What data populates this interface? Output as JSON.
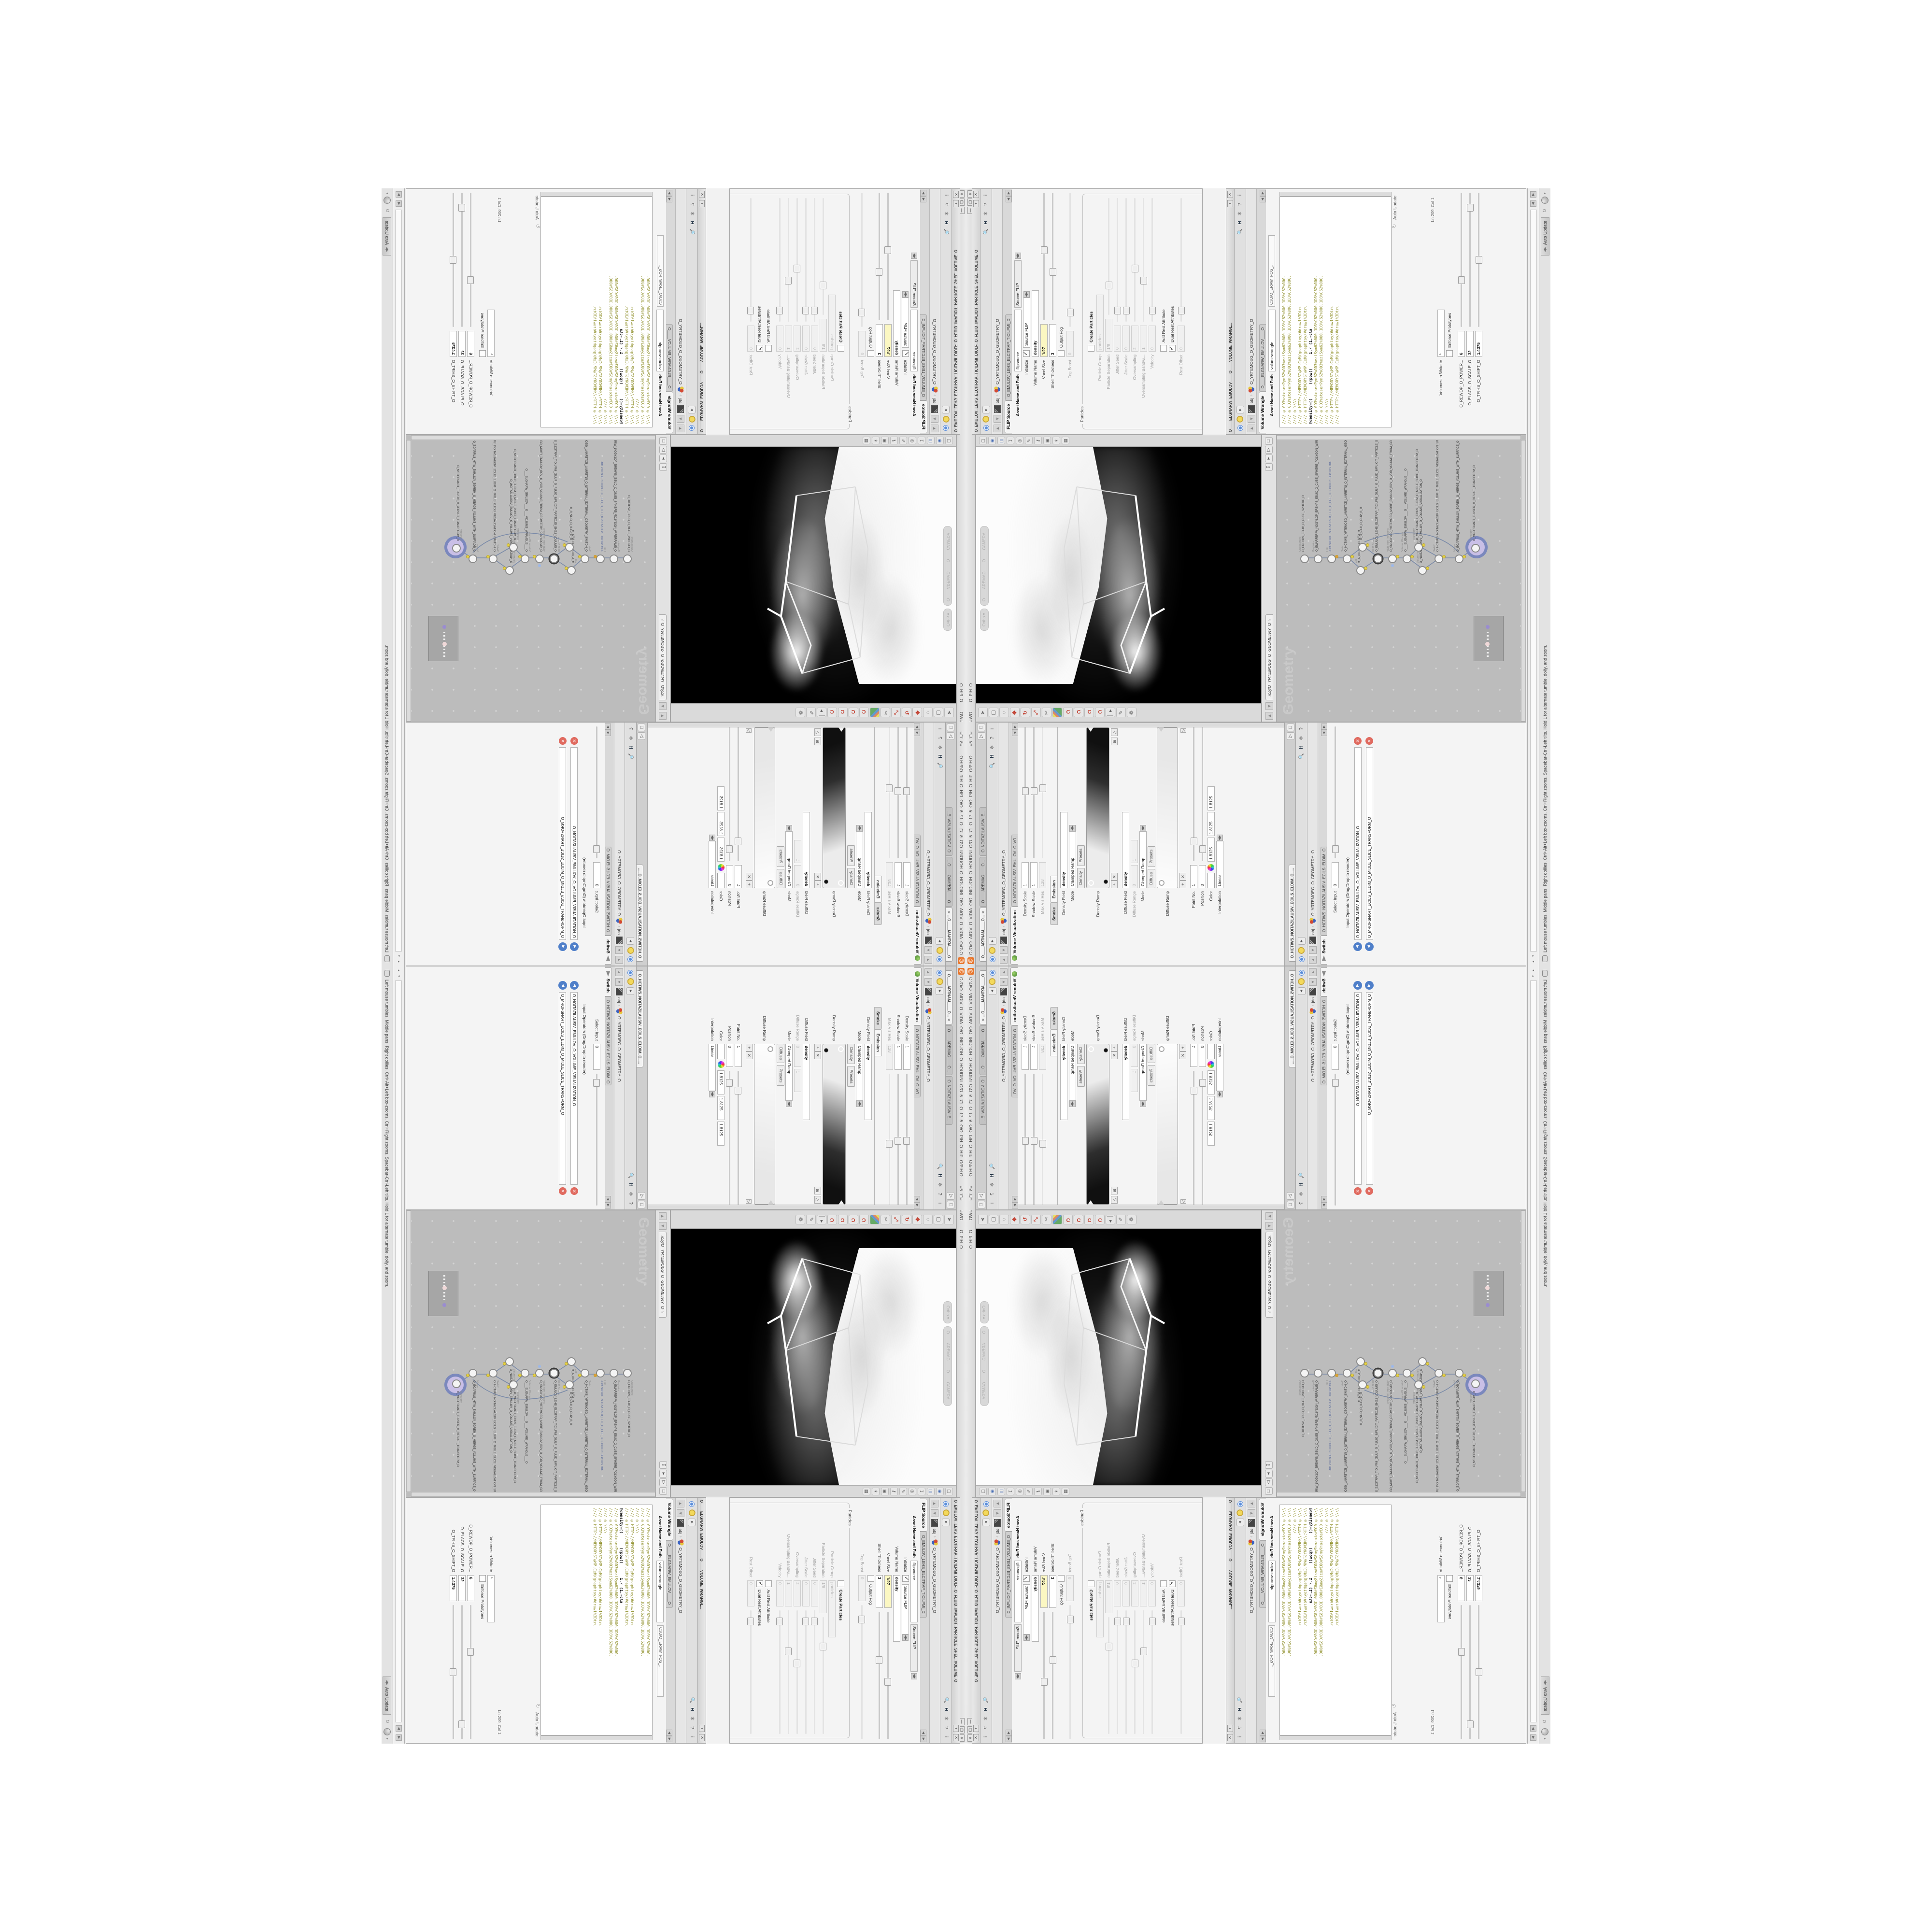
{
  "title_bar": {
    "title": "C:/O/O_AIDIV_O_VIDIA_O/O_INIDUOH_O_HOUDINI_O/O_5_71_O_17_5_O/O_PIH_O_HIP_O/PIH.O____#5_71#____#WO____O_PIH_O",
    "minimize": "—",
    "maximize": "❐",
    "close": "✕"
  },
  "breadcrumb": {
    "root": "obj",
    "node": "O_YRTEMOEG_O_GEOMETRY_O"
  },
  "volviz": {
    "pane_tabs": [
      "O____ARTNAM____O...",
      "O____AREMAC____O...",
      "O_NOITAZILAUSIV_E..."
    ],
    "tab": "Volume Visualization",
    "tab_name": "O_NOITAZILAUSIV_EMULOV_O_VO",
    "params": {
      "density_scale_label": "Density Scale",
      "density_scale": "1",
      "shadow_scale_label": "Shadow Scale",
      "shadow_scale": "1",
      "maxvisres_label": "Max Vis Res",
      "maxvisres": "128",
      "folder_tab_smoke": "Smoke",
      "folder_tab_emission": "Emission",
      "density_field_label": "Density Field",
      "density_field": "density",
      "mode_label": "Mode",
      "mode": "Clamped Ramp",
      "density_preset_kind": "Density",
      "presets_label": "Presets",
      "density_ramp_label": "Density Ramp",
      "diffuse_field_label": "Diffuse Field",
      "diffuse_field": "density",
      "diffuse_range_label": "Diffuse Range",
      "diffuse_range_min": "0",
      "diffuse_range_max": "1",
      "mode2_label": "Mode",
      "mode2": "Clamped Ramp",
      "diffuse_preset_kind": "Diffuse",
      "diffuse_ramp_label": "Diffuse Ramp",
      "point_no_label": "Point No.",
      "point_no": "1",
      "position_label": "Position",
      "position": "0",
      "color_label": "Color",
      "color_r": "1.8125",
      "color_g": "1.8125",
      "color_b": "1.8125",
      "interpolation_label": "Interpolation",
      "interpolation": "Linear"
    }
  },
  "switch_win": {
    "pane_tab": "O_HCTIWS_NOITAZILAUSIV_ECILS_ELDIM_O_...",
    "tab": "Switch",
    "tab_name": "O_HCTIWS_NOITAZILAUSIV_ECILS_ELDIM_O_",
    "select_input_label": "Select Input",
    "select_input": "0",
    "input_ops_label": "Input Operators (Drag/Drop to reorder)",
    "input1": "O_NOITAZILAUSIV_EMULOV_O_VOLUME_VISUALIZATION_O",
    "input2": "O_MROFSNART_ECILS_ELDIM_O_MIDLE_SLICE_TRANSFORM_O"
  },
  "viewport": {
    "camera_pill": "O____AREMAC____O____CAMERA_",
    "ortho_pill": "Ortho"
  },
  "network": {
    "path_tab": "/obj/O_YRTEMOEG_O_GEOMETRY_O",
    "watermark": "Geometry",
    "nodes": [
      {
        "type": "CubeSphere",
        "name": "O_EREHPS_EBUC_O_CUBE_SPHERE_O"
      },
      {
        "type": "PolyWire",
        "name": "O_EMARFERIW_NOGYLOP_EREHPS_EBUC_O_CUBE_SPHERE_POLYGON_WIREFRAME_O"
      },
      {
        "type": "File",
        "name": "JBO.SD3.PETS.TRPDLS.B_ELIF_O_FILE_B.SLDPRT.STEP.3DS.OBJ"
      },
      {
        "type": "Switch",
        "name": "O_HCTIWS_YRTEMOEG_LANRETXE_LANRETNI_O_INTERNAL_EXTERNAL_GEOMETRY_SWITCH_O"
      },
      {
        "type": "Clip",
        "name": "O_A_PILC_O_CLIP_A_O"
      },
      {
        "type": "Clip",
        "name": "O_B_PILC_O_CLIP_B_O"
      },
      {
        "type": "FLIP Source",
        "name": "O_EMULOV_LEHS_ELCITRAP_TICILPMI_DIULF_O_FLUID_IMPLICIT_PARTICLE_SHEL_VOLUME_O"
      },
      {
        "type": "VDB from Polygons",
        "name": "O_SNOGYLOP_YRTEMOEG_MORF_EMULOV_BDV_O_VDB_VOLUME_FROM_GEOMETRY_POLYGONS_O"
      },
      {
        "type": "Volume Wrangle",
        "name": "O___ELGNARW_EMULOV___O___VOLUME_WRANGLE___O"
      },
      {
        "type": "Volume Visualization",
        "name": "O_NOITAZILAUSIV_EMULOV_O_VOLUME_VISUALIZATION_O"
      },
      {
        "type": "Transform",
        "name": "O_MROFSNART_ECILS_ELDIM_O_MIDLE_SLICE_TRANSFORM_O"
      },
      {
        "type": "Switch",
        "name": "O_HCTIWS_NOITAZILAUSIV_ECILS_ELDIM_O_MIDLE_SLICE_VISUALIZATION_SWITCH_O"
      },
      {
        "type": "Merge",
        "name": "O_ECAFRUS_HTIW_EMULOV_EGREM_O_MERGE_VOLUME_WITH_SURFACE_O"
      },
      {
        "type": "Transform",
        "name": "O_MROFSNART_TLUSER_O_RESULT_TRANSFORM_O"
      }
    ]
  },
  "flip": {
    "window_title": "O_EMULOV_LEHS_ELCITRAP_TICILPMI_DIULF_O_FLUID_IMPLICIT_PARTICLE_SHEL_VOLUME_O",
    "tab": "FLIP Source",
    "tab_name": "O_EMULOV_LEHS_ELCITRAP_TICILPMI_DI",
    "asset_label": "Asset Name and Path",
    "asset_name": "flipsource",
    "asset_path": "Source FLIP",
    "params": [
      {
        "label": "Initialize",
        "value": "Source FLIP",
        "kind": "menu"
      },
      {
        "label": "Volume Name",
        "value": "density",
        "kind": "boldfield"
      },
      {
        "label": "Voxel Size",
        "value": "1/27",
        "kind": "yellow"
      },
      {
        "label": "Shell Thickness",
        "value": "3",
        "kind": "field"
      },
      {
        "label": "Output Fog",
        "value": "",
        "kind": "checkbox-off"
      },
      {
        "label": "Fog Boost",
        "value": "0",
        "kind": "disfield"
      }
    ],
    "particles_group_label": "Particles",
    "particles": [
      {
        "label": "Create Particles",
        "value": "",
        "kind": "checkbox-off-bold"
      },
      {
        "label": "Particle Group",
        "value": "particles",
        "kind": "disfield"
      },
      {
        "label": "Particle Separation",
        "value": "1/9",
        "kind": "disfield"
      },
      {
        "label": "Jitter Seed",
        "value": "0",
        "kind": "disfield"
      },
      {
        "label": "Jitter Scale",
        "value": "0",
        "kind": "disfield"
      },
      {
        "label": "Oversampling",
        "value": "2",
        "kind": "disfield"
      },
      {
        "label": "Oversampling Bandwi...",
        "value": "1",
        "kind": "disfield"
      },
      {
        "label": "Velocity",
        "value": "0",
        "kind": "disfield"
      },
      {
        "label": "Add Rest Attribute",
        "value": "",
        "kind": "checkbox-off"
      },
      {
        "label": "Dual Rest Attributes",
        "value": "",
        "kind": "checkbox-on"
      },
      {
        "label": "Rest Offset",
        "value": "0",
        "kind": "disfield"
      }
    ]
  },
  "wrangle": {
    "window_title": "O____ELGNARW_EMULOV____O____VOLUME_WRANGL...",
    "tab": "Volume Wrangle",
    "tab_name": "O____ELGNARW_EMULOV____O",
    "asset_label": "Asset Name and Path",
    "asset_name": "volumewrangle",
    "asset_path": "C:/O/O_ERAWTFOS_...",
    "code": [
      "//// ◎ 0D3%steserPym62%0D3%eziSym62%000.1D3%C62%000.1D3%C62%000.",
      "//// ◎ 0D3%steserPym62%0D3%eziSym62%000.1D3%C62%000.1D3%C62%000.",
      "//// ◎ \\\\\\\\",
      "//// ◎ HTTP://MEMORYST◎MP.C◎M/graphtoy/#draw1%3Dtru",
      "//// ◎ HTTP://MEMORYST◎MP.C◎M/graphtoy/#draw1%3Dtru",
      "",
      "@density=((      ((pow((      1./ (1.-cla",
      "",
      "//// ◎ 0D3%steserPym62%0D3%eziSym62%000.1D3%C62%000.1D3%C62%000.",
      "//// ◎ 0D3%steserPym62%0D3%eziSym62%000.1D3%C62%000.1D3%C62%000.",
      "//// ◎ \\\\\\\\",
      "//// ◎ HTTP://MEMORYST◎MP.C◎M/graphtoy/#draw1%3Dtru",
      "//// ◎ HTTP://MEMORYST◎MP.C◎M/graphtoy/#draw1%3Dtru"
    ],
    "auto_update": "Auto Update",
    "line_col": "Ln 209, Col 1",
    "volumes_label": "Volumes to Write to",
    "volumes_value": "*",
    "enforce_label": "Enforce Prototypes",
    "power_label": "O_REWOP_O_POWER...",
    "power": "6",
    "scale_label": "O_ELACS_O_SCALE_O",
    "scale": "32",
    "shift_label": "O_TFIHS_O_SHIFT_O",
    "shift": "1.4375"
  },
  "statusbar": {
    "help": "Left mouse tumbles. Middle pans. Right dollies. Ctrl+Alt+Left box-zooms. Ctrl+Right zooms. Spacebar-Ctrl-Left tilts. Hold L for alternate tumble, dolly, and zoom.",
    "auto_update": "Auto Update"
  },
  "colors": {
    "houdini_orange": "#e8762c",
    "network_canvas": "#bcbcbc",
    "selected_node_halo": "#7b88bd",
    "selected_node_inner": "#c9bfe6",
    "code_olive": "#8f8f2a",
    "yellow_field": "#fbf7c2",
    "flag_yellow": "#e3cf48"
  }
}
